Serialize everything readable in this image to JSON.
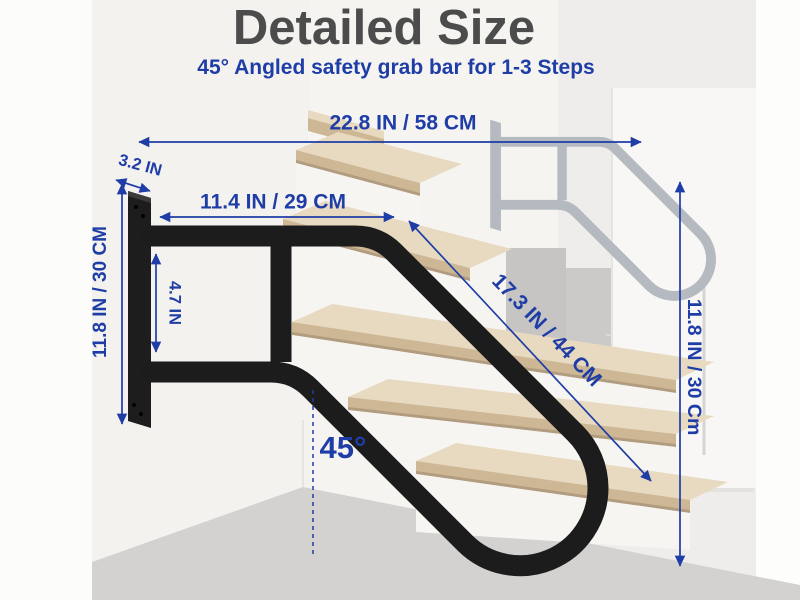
{
  "header": {
    "title": "Detailed Size",
    "subtitle": "45° Angled safety grab bar for 1-3 Steps"
  },
  "dimensions": {
    "top_width": "22.8 IN / 58 CM",
    "plate_depth": "3.2 IN",
    "upper_bar_length": "11.4 IN / 29 CM",
    "left_height": "11.8 IN / 30 CM",
    "bar_gap": "4.7 IN",
    "diagonal_length": "17.3 IN / 44 CM",
    "angle": "45°",
    "right_height": "11.8 IN / 30 Cm"
  },
  "colors": {
    "annotation_blue": "#1e3da6",
    "title_gray": "#4c4c4c",
    "rail_black": "#1c1c1c",
    "ghost_rail_gray": "#b5bac1",
    "wood_tread": "#d9c6aa",
    "floor_gray": "#d3d2d0"
  }
}
